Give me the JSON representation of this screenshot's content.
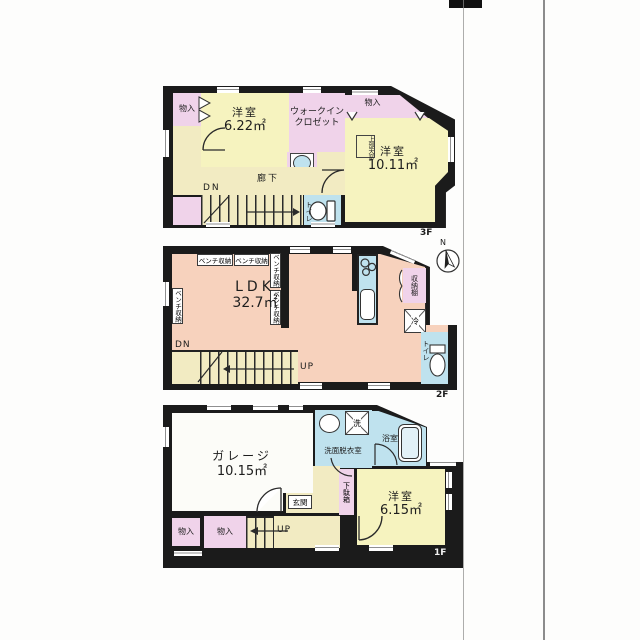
{
  "document_type": "japanese-house-floor-plan",
  "colors": {
    "wall": "#1b1b1b",
    "room_yellow": "#f6f3bf",
    "room_pink": "#f0d3ea",
    "room_salmon": "#f7d2bd",
    "water_blue": "#bfe2ee",
    "corridor_cream": "#f2ebc2",
    "garage_white": "#fcfcf8"
  },
  "compass": {
    "north": "N"
  },
  "floor3": {
    "floor_label": "3F",
    "storage_top_left": "物入",
    "storage_top_right": "物入",
    "storage_bottom_left": "物入",
    "bedroom1": {
      "name": "洋室",
      "area": "6.22㎡"
    },
    "walk_in_closet": {
      "line1": "ウォークイン",
      "line2": "クロゼット"
    },
    "bedroom2": {
      "name": "洋室",
      "area": "10.11㎡"
    },
    "skylight_note": "上部天窓",
    "hallway": "廊下",
    "stairs_down": "DN",
    "toilet": "トイレ"
  },
  "floor2": {
    "floor_label": "2F",
    "bench_storage": "ベンチ収納",
    "ldk": {
      "name": "LDK",
      "area": "32.7㎡"
    },
    "storage_shelf": "収納棚",
    "refrigerator": "冷",
    "toilet": "トイレ",
    "stairs_down": "DN",
    "stairs_up": "UP"
  },
  "floor1": {
    "floor_label": "1F",
    "garage": {
      "name": "ガレージ",
      "area": "10.15㎡"
    },
    "washroom": "洗面脱衣室",
    "washer": "洗",
    "bathroom": "浴室",
    "entrance": "玄関",
    "shoe_cabinet": "下駄箱",
    "bedroom": {
      "name": "洋室",
      "area": "6.15㎡"
    },
    "storage_a": "物入",
    "storage_b": "物入",
    "stairs_up": "UP"
  }
}
